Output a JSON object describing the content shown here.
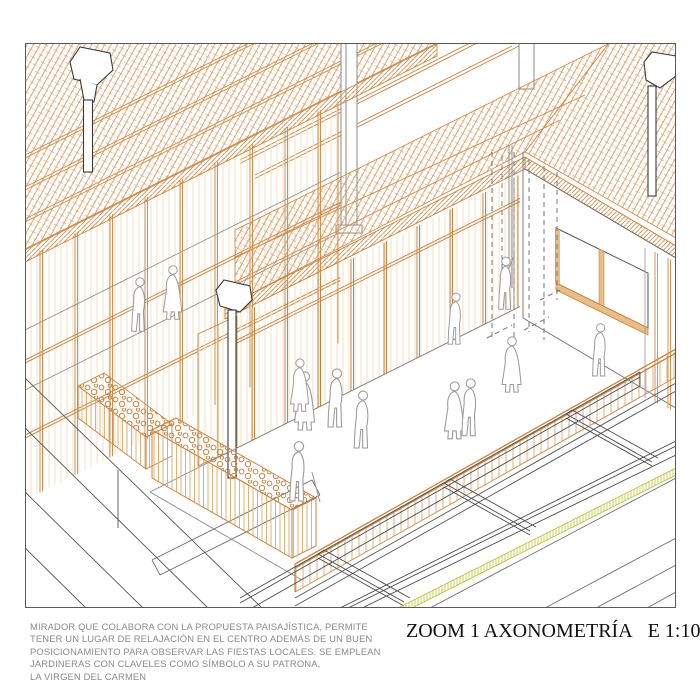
{
  "caption": {
    "lines": [
      "MIRADOR QUE COLABORA CON LA PROPUESTA PAISAJÍSTICA, PERMITE",
      "TENER UN LUGAR DE RELAJACIÓN EN EL CENTRO ADEMÁS DE UN BUEN",
      "POSICIONAMIENTO PARA OBSERVAR LAS FIESTAS LOCALES. SE EMPLEAN",
      "JARDINERAS CON CLAVELES COMO SÍMBOLO A SU PATRONA,",
      "LA VIRGEN DEL CARMEN"
    ],
    "color": "#8a8a8a"
  },
  "titleblock": {
    "title": "ZOOM 1 AXONOMETRÍA",
    "scale": "E 1:100",
    "color": "#111111"
  },
  "drawing": {
    "view": "axonometric",
    "colors": {
      "timber": "#c9833f",
      "timber_light": "#cf8a45",
      "glass_hatch": "#f3e1c6",
      "figure_outline": "#9b9b9b",
      "linework": "#4a4a4a",
      "grass_accent": "#c0c545"
    },
    "elements": [
      "hatched-roofs",
      "timber-glass-facade",
      "veranda-fascia",
      "terrace",
      "railing",
      "planters-with-carnations",
      "human-figures",
      "garden-beds",
      "rainwater-hoppers-downpipes",
      "window",
      "terrain-slope",
      "street"
    ]
  }
}
